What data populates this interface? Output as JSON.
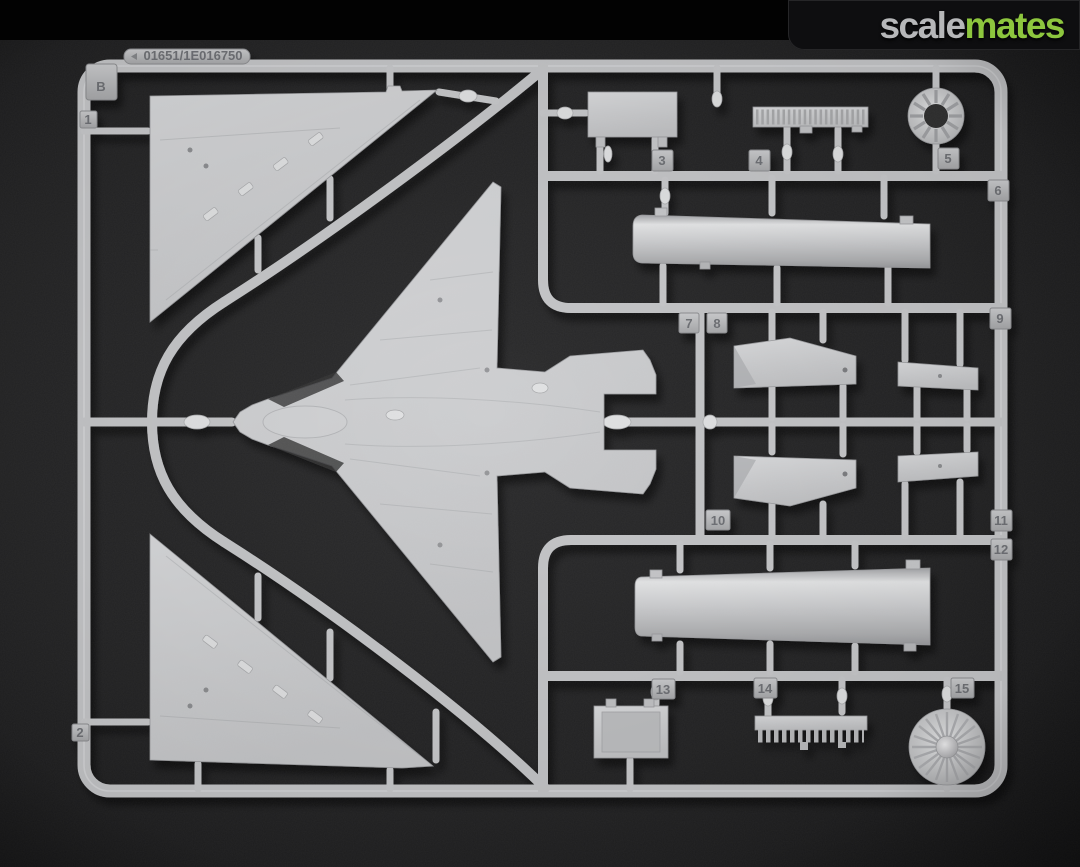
{
  "site": {
    "logo": {
      "prefix": "scale",
      "suffix": "mates"
    }
  },
  "photo": {
    "alt": "light gray injection-molded plastic model kit sprue B with delta-wing aircraft fuselage, wing panels, drop tanks and turbine parts on dark foam background",
    "sprue_letter": "B",
    "mold_stamp": "01651/1E016750",
    "part_numbers": [
      "1",
      "2",
      "3",
      "4",
      "5",
      "6",
      "7",
      "8",
      "9",
      "10",
      "11",
      "12",
      "13",
      "14",
      "15"
    ]
  },
  "colors": {
    "topbar": "#020202",
    "logo_prefix": "#b6b7b9",
    "logo_suffix": "#8dc63e",
    "background": "#222223",
    "plastic": "#c7c8ca"
  }
}
